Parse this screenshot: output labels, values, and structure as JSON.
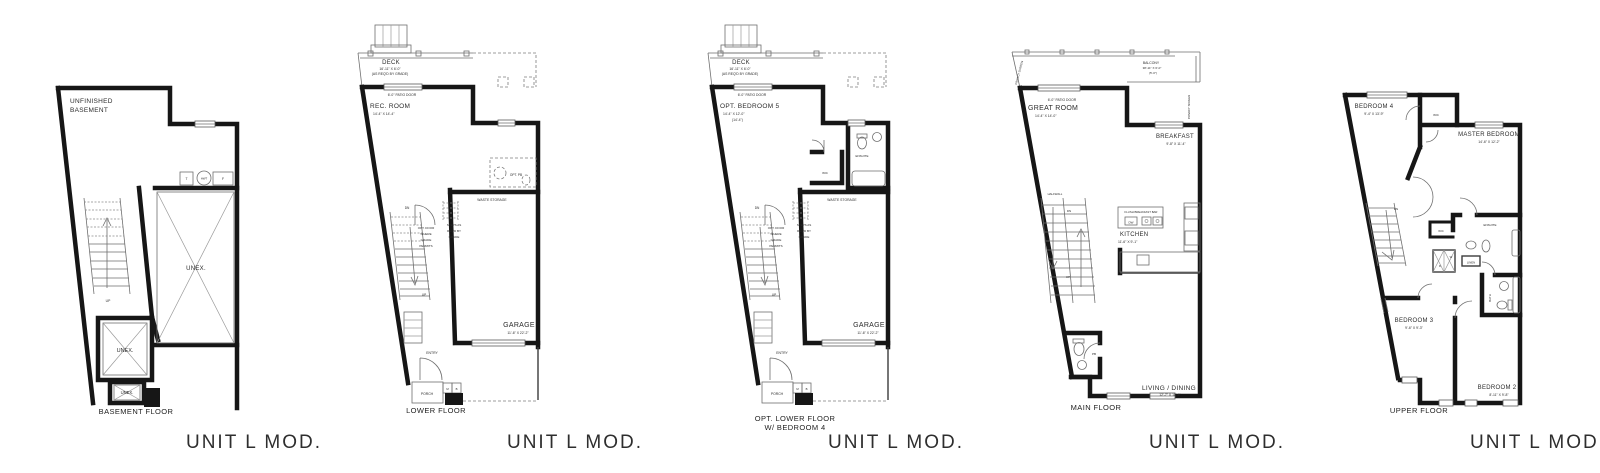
{
  "plans": [
    {
      "key": "basement",
      "floor_label": "BASEMENT FLOOR",
      "unit_label": "UNIT L MOD.",
      "labels": {
        "line1": "UNFINISHED",
        "line2": "BASEMENT",
        "t": "T",
        "hwt": "HWT",
        "f": "F",
        "unex_large": "UNEX.",
        "unex_small": "UNEX.",
        "unex_tiny": "UNEX.",
        "up": "UP"
      }
    },
    {
      "key": "lower-floor",
      "floor_label": "LOWER FLOOR",
      "unit_label": "UNIT L MOD.",
      "labels": {
        "deck": "DECK",
        "deck_dims": "16'-11\" X 6'-0\"",
        "deck_note": "(AS REQ'D BY GRADE)",
        "patio_door": "6'-0\" PATIO DOOR",
        "room": "REC. ROOM",
        "room_dims": "14'-4\" X 14'-4\"",
        "opt_pb": "OPT. PB",
        "waste_storage": "WASTE STORAGE",
        "dn": "DN",
        "up": "UP",
        "opt_door_l1": "OPT. DOOR",
        "opt_door_l2": "WHERE",
        "opt_door_l3": "GRADE",
        "opt_door_l4": "PERMITS",
        "steps_l1": "STEPS AS",
        "steps_l2": "REQ'D BY",
        "steps_l3": "GRADE",
        "garage": "GARAGE",
        "garage_dims": "11'-6\" X 22'-2\"",
        "entry": "ENTRY",
        "porch": "PORCH",
        "m": "M",
        "b": "B"
      }
    },
    {
      "key": "opt-lower-floor",
      "floor_label_l1": "OPT. LOWER FLOOR",
      "floor_label_l2": "W/ BEDROOM 4",
      "unit_label": "UNIT L MOD.",
      "labels": {
        "deck": "DECK",
        "deck_dims": "16'-11\" X 6'-0\"",
        "deck_note": "(AS REQ'D BY GRADE)",
        "patio_door": "6'-0\" PATIO DOOR",
        "room": "OPT. BEDROOM 5",
        "room_dims": "14'-4\" X 12'-0\"",
        "room_dims2": "(14'-4\")",
        "wic": "WIC",
        "ensuite": "ENSUITE",
        "waste_storage": "WASTE STORAGE",
        "dn": "DN",
        "up": "UP",
        "opt_door_l1": "OPT. DOOR",
        "opt_door_l2": "WHERE",
        "opt_door_l3": "GRADE",
        "opt_door_l4": "PERMITS",
        "steps_l1": "STEPS AS",
        "steps_l2": "REQ'D BY",
        "steps_l3": "GRADE",
        "garage": "GARAGE",
        "garage_dims": "11'-6\" X 22'-2\"",
        "entry": "ENTRY",
        "porch": "PORCH",
        "m": "M",
        "b": "B"
      }
    },
    {
      "key": "main-floor",
      "floor_label": "MAIN FLOOR",
      "unit_label": "UNIT L MOD.",
      "labels": {
        "balcony": "BALCONY",
        "balcony_dims": "38'-11\" X 6'-0\"",
        "balcony_note": "(5'-0\")",
        "privacy_left": "PRIVACY SCREEN",
        "privacy_right": "PRIVACY SCREEN",
        "patio_door": "6'-0\" PATIO DOOR",
        "great_room": "GREAT ROOM",
        "great_room_dims": "14'-4\" X 14'-0\"",
        "breakfast": "BREAKFAST",
        "breakfast_dims": "9'-8\" X 11'-4\"",
        "halfwall": "HALFWALL",
        "dn": "DN",
        "up": "UP",
        "bar": "FLUSH BREAKFAST BAR",
        "dw": "DW",
        "kitchen": "KITCHEN",
        "kitchen_dims": "11'-6\" X 9'-1\"",
        "pb": "PB",
        "living": "LIVING / DINING",
        "living_dims": "12'-7\" X 18'-6\""
      }
    },
    {
      "key": "upper-floor",
      "floor_label": "UPPER FLOOR",
      "unit_label": "UNIT L MOD.",
      "labels": {
        "bedroom4": "BEDROOM 4",
        "bedroom4_dims": "9'-4\" X 13'-9\"",
        "wic1": "WIC",
        "master": "MASTER BEDROOM",
        "master_dims": "14'-6\" X 12'-2\"",
        "dn": "DN",
        "w": "W",
        "d": "D",
        "wic2": "WIC",
        "ensuite": "ENSUITE",
        "linen": "LINEN",
        "bath": "BATH",
        "bedroom3": "BEDROOM 3",
        "bedroom3_dims": "9'-6\" X 9'-3\"",
        "bedroom2": "BEDROOM 2",
        "bedroom2_dims": "8'-11\" X 9'-8\""
      }
    }
  ]
}
